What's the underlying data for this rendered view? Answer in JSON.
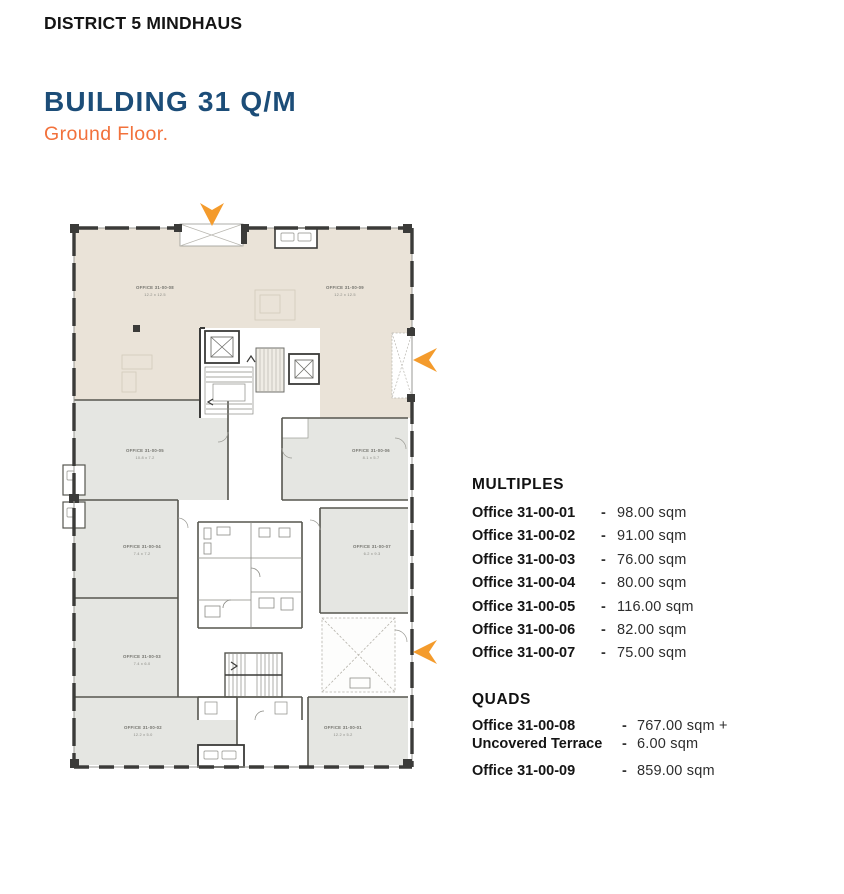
{
  "page": {
    "district_label": "DISTRICT 5 MINDHAUS",
    "building_title": "BUILDING 31 Q/M",
    "floor_subtitle": "Ground Floor."
  },
  "legend": {
    "multiples": {
      "heading": "MULTIPLES",
      "rows": [
        {
          "name": "Office 31-00-01",
          "dash": "-",
          "value": "98.00 sqm"
        },
        {
          "name": "Office 31-00-02",
          "dash": "-",
          "value": "91.00 sqm"
        },
        {
          "name": "Office 31-00-03",
          "dash": "-",
          "value": "76.00 sqm"
        },
        {
          "name": "Office 31-00-04",
          "dash": "-",
          "value": "80.00 sqm"
        },
        {
          "name": "Office 31-00-05",
          "dash": "-",
          "value": "116.00 sqm"
        },
        {
          "name": "Office 31-00-06",
          "dash": "-",
          "value": "82.00 sqm"
        },
        {
          "name": "Office 31-00-07",
          "dash": "-",
          "value": "75.00 sqm"
        }
      ]
    },
    "quads": {
      "heading": "QUADS",
      "rows": [
        {
          "name": "Office 31-00-08",
          "dash": "-",
          "value": "767.00 sqm +"
        },
        {
          "name": "Uncovered Terrace",
          "dash": "-",
          "value": "6.00 sqm"
        },
        {
          "name": "Office 31-00-09",
          "dash": "-",
          "value": "859.00 sqm"
        }
      ]
    }
  },
  "floorplan": {
    "rooms": [
      {
        "id": "office-31-00-08",
        "label": "OFFICE 31-00-08",
        "dims": "12.2 x 12.5"
      },
      {
        "id": "office-31-00-09",
        "label": "OFFICE 31-00-09",
        "dims": "12.2 x 12.5"
      },
      {
        "id": "office-31-00-05",
        "label": "OFFICE 31-00-05",
        "dims": "10.8 x 7.2"
      },
      {
        "id": "office-31-00-06",
        "label": "OFFICE 31-00-06",
        "dims": "8.1 x 5.7"
      },
      {
        "id": "office-31-00-04",
        "label": "OFFICE 31-00-04",
        "dims": "7.4 x 7.2"
      },
      {
        "id": "office-31-00-07",
        "label": "OFFICE 31-00-07",
        "dims": "6.2 x 9.3"
      },
      {
        "id": "office-31-00-03",
        "label": "OFFICE 31-00-03",
        "dims": "7.4 x 6.0"
      },
      {
        "id": "office-31-00-02",
        "label": "OFFICE 31-00-02",
        "dims": "12.2 x 5.0"
      },
      {
        "id": "office-31-00-01",
        "label": "OFFICE 31-00-01",
        "dims": "12.2 x 5.2"
      }
    ],
    "arrows": [
      {
        "icon": "arrow-down-icon",
        "direction": "down"
      },
      {
        "icon": "arrow-left-icon",
        "direction": "left"
      },
      {
        "icon": "arrow-left-icon",
        "direction": "left"
      }
    ],
    "colors": {
      "room_beige": "#eae3d8",
      "room_gray": "#e5e6e2",
      "wall_dark": "#3b3b39",
      "arrow_orange": "#f49b2c",
      "title_blue": "#1c4d78",
      "subtitle_orange": "#f2713b"
    }
  }
}
